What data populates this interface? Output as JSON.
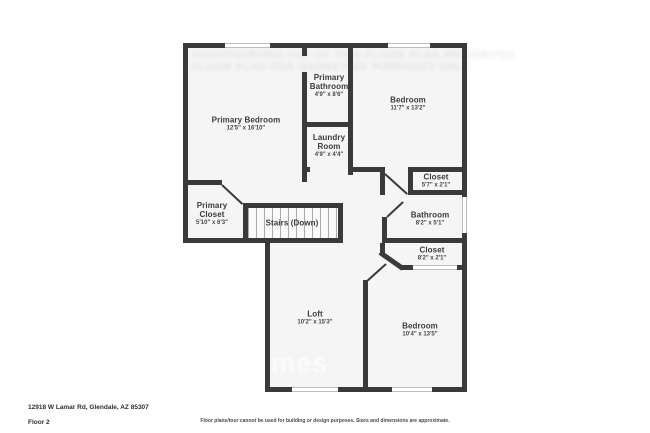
{
  "footer": {
    "address": "12918 W Lamar Rd, Glendale, AZ 85307",
    "floor_label": "Floor 2",
    "disclaimer": "Floor plans/tour cannot be used for building or design purposes. Sizes and dimensions are approximate."
  },
  "watermark": {
    "top_line_1": "UNAUTHORIZED USE OF THIS FLOOR PLAN PROHIBITED",
    "top_line_2": "FLOOR PLAN FOR MARKETING PURPOSES ONLY",
    "corner_fragment": "mes"
  },
  "palette": {
    "wall": "#3a3a3a",
    "room_fill": "#f5f5f5",
    "outside": "#ffffff",
    "label_text": "#3a3a40",
    "window_line": "#bdbdbd"
  },
  "rooms": [
    {
      "name": "Primary Bedroom",
      "dims": "12'5\" x 16'10\""
    },
    {
      "name": "Primary Bathroom",
      "dims": "4'9\" x 8'6\""
    },
    {
      "name": "Bedroom",
      "dims": "11'7\" x 13'2\""
    },
    {
      "name": "Laundry Room",
      "dims": "4'9\" x 4'4\""
    },
    {
      "name": "Closet",
      "dims": "5'7\" x 2'1\""
    },
    {
      "name": "Primary Closet",
      "dims": "5'10\" x 6'3\""
    },
    {
      "name": "Stairs (Down)",
      "dims": ""
    },
    {
      "name": "Bathroom",
      "dims": "8'2\" x 5'1\""
    },
    {
      "name": "Closet",
      "dims": "8'2\" x 2'1\""
    },
    {
      "name": "Loft",
      "dims": "10'2\" x 15'3\""
    },
    {
      "name": "Bedroom",
      "dims": "10'4\" x 13'5\""
    }
  ]
}
